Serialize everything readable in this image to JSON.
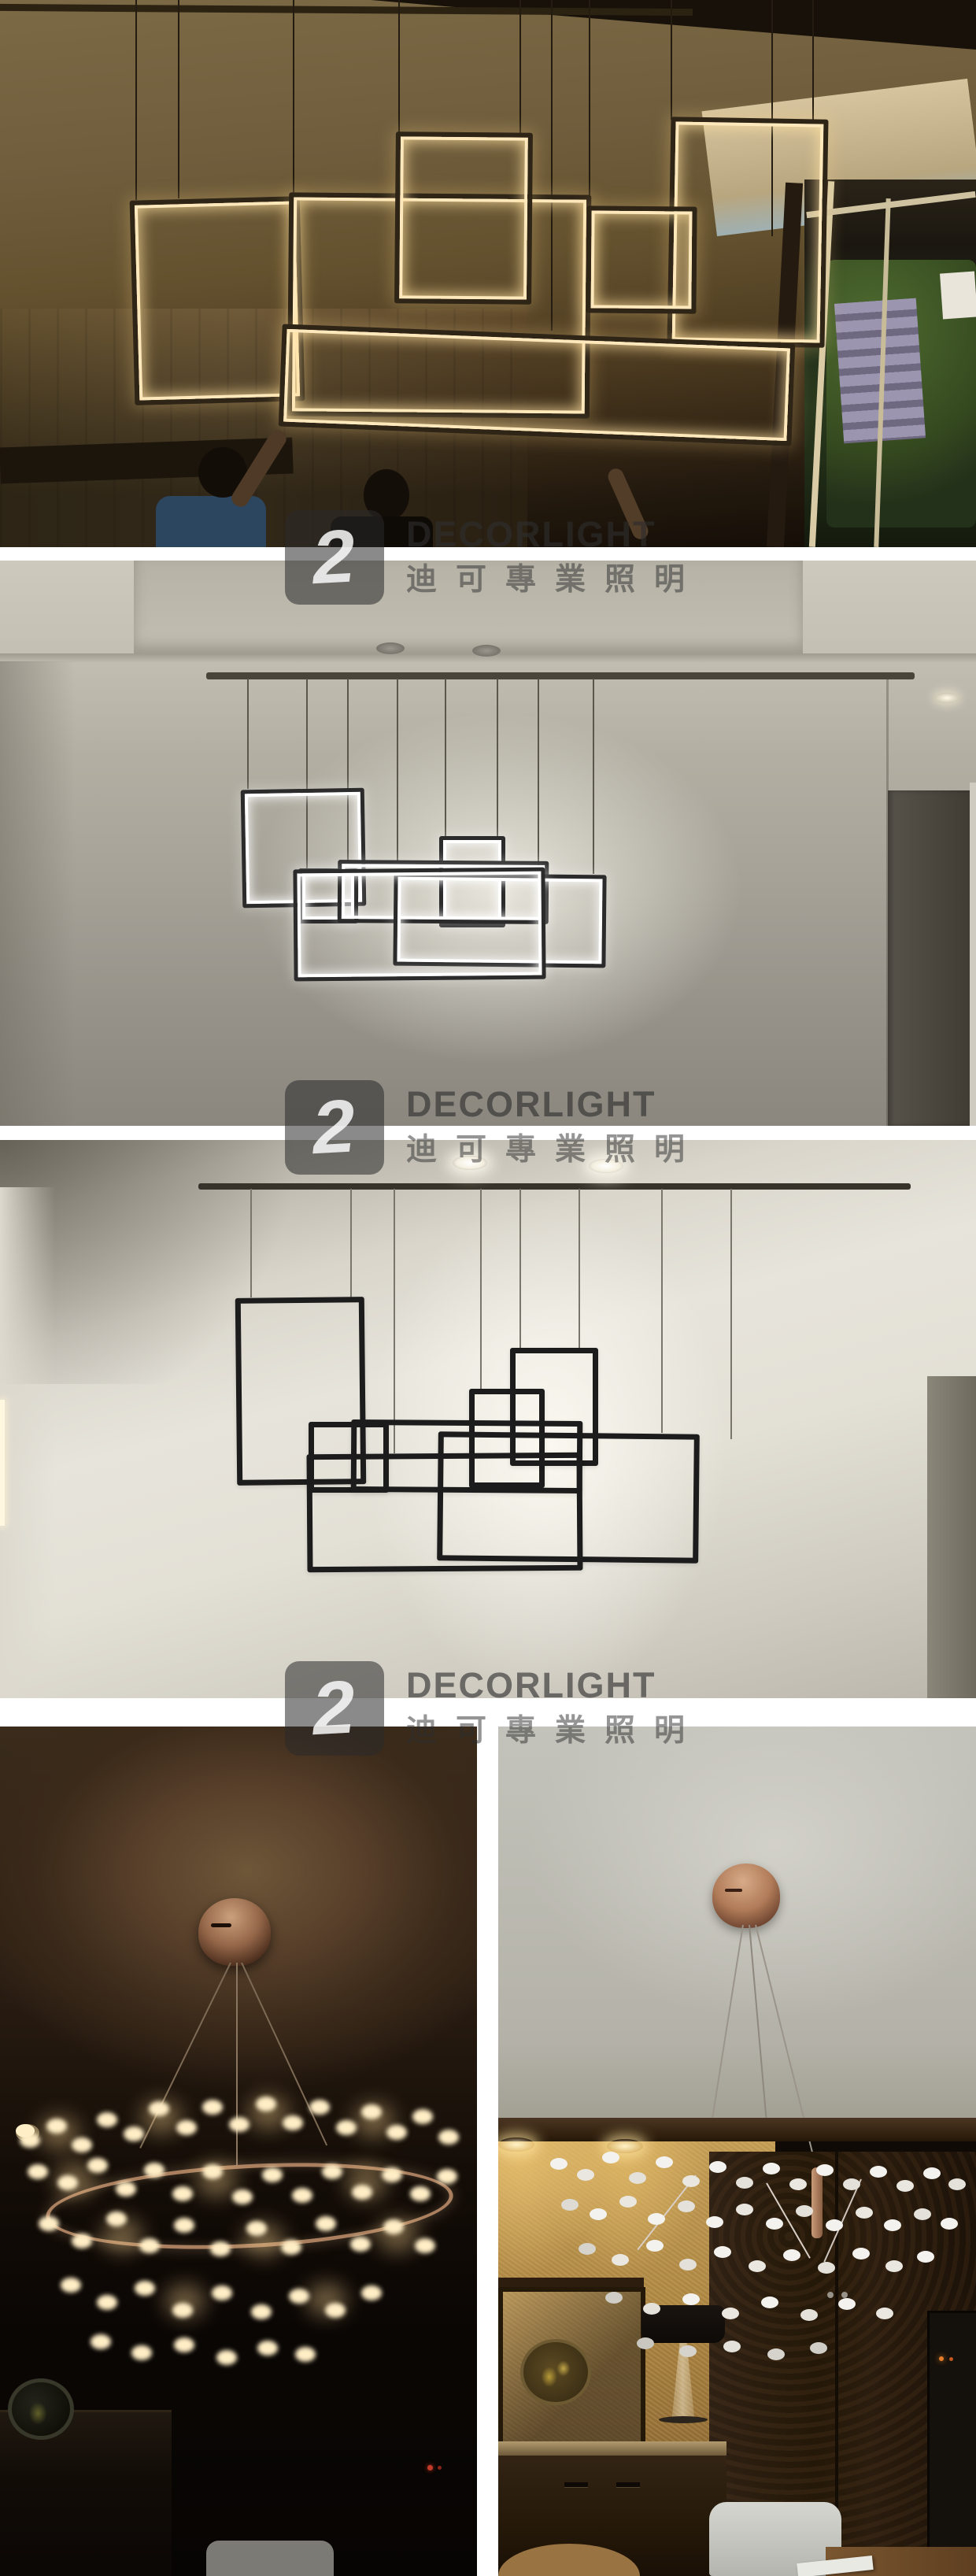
{
  "watermark": {
    "logo_glyph": "2",
    "brand": "DECORLIGHT",
    "brand_zh": "迪可專業照明"
  },
  "colors": {
    "glow_warm": "#ffe9bc",
    "glow_white": "#ffffff",
    "frame_dark_warm": "#2e2517",
    "frame_dark": "#2b2b2b",
    "frame_black": "#1c1c1c",
    "copper": "#a97f5f",
    "petal_warm": "#ffeec6",
    "petal_white": "#f3f2ee",
    "watermark_ink": "#2e2e2e"
  }
}
